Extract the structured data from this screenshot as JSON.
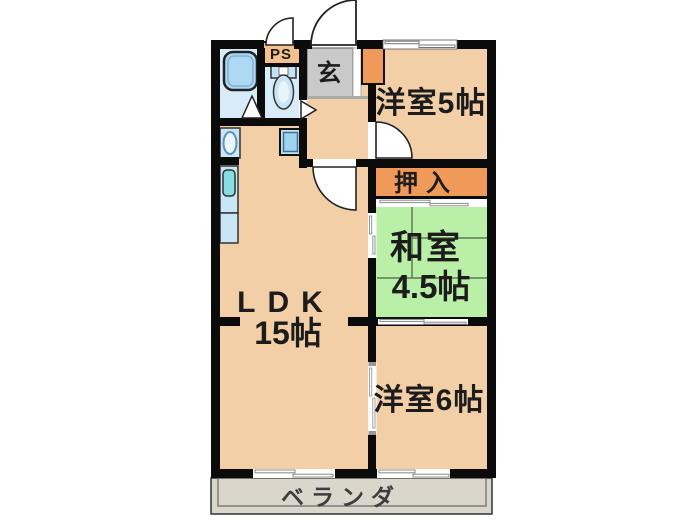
{
  "floorplan": {
    "title": "2LDK apartment floor plan",
    "labels": {
      "western5": "洋室5帖",
      "oshiire": "押入",
      "washitsu_name": "和室",
      "washitsu_size": "4.5帖",
      "western6": "洋室6帖",
      "ldk_name": "LDK",
      "ldk_size": "15帖",
      "veranda": "ベランダ",
      "genkan": "玄",
      "ps": "PS"
    },
    "colors": {
      "wall": "#0b0b0b",
      "room_peach": "#F2CFA7",
      "tatami_green": "#B9EFA6",
      "closet_orange": "#F09A5A",
      "ps_orange": "#F4C08C",
      "genkan_gray": "#C9C9C9",
      "veranda_gray": "#DBD6CB",
      "bath_floor_blue": "#D7EBF9",
      "fixture_blue": "#AFD9F2",
      "fixture_light_blue": "#C9E6F7",
      "sink_cyan": "#86DEE2",
      "tatami_line": "#5c7a55"
    }
  }
}
